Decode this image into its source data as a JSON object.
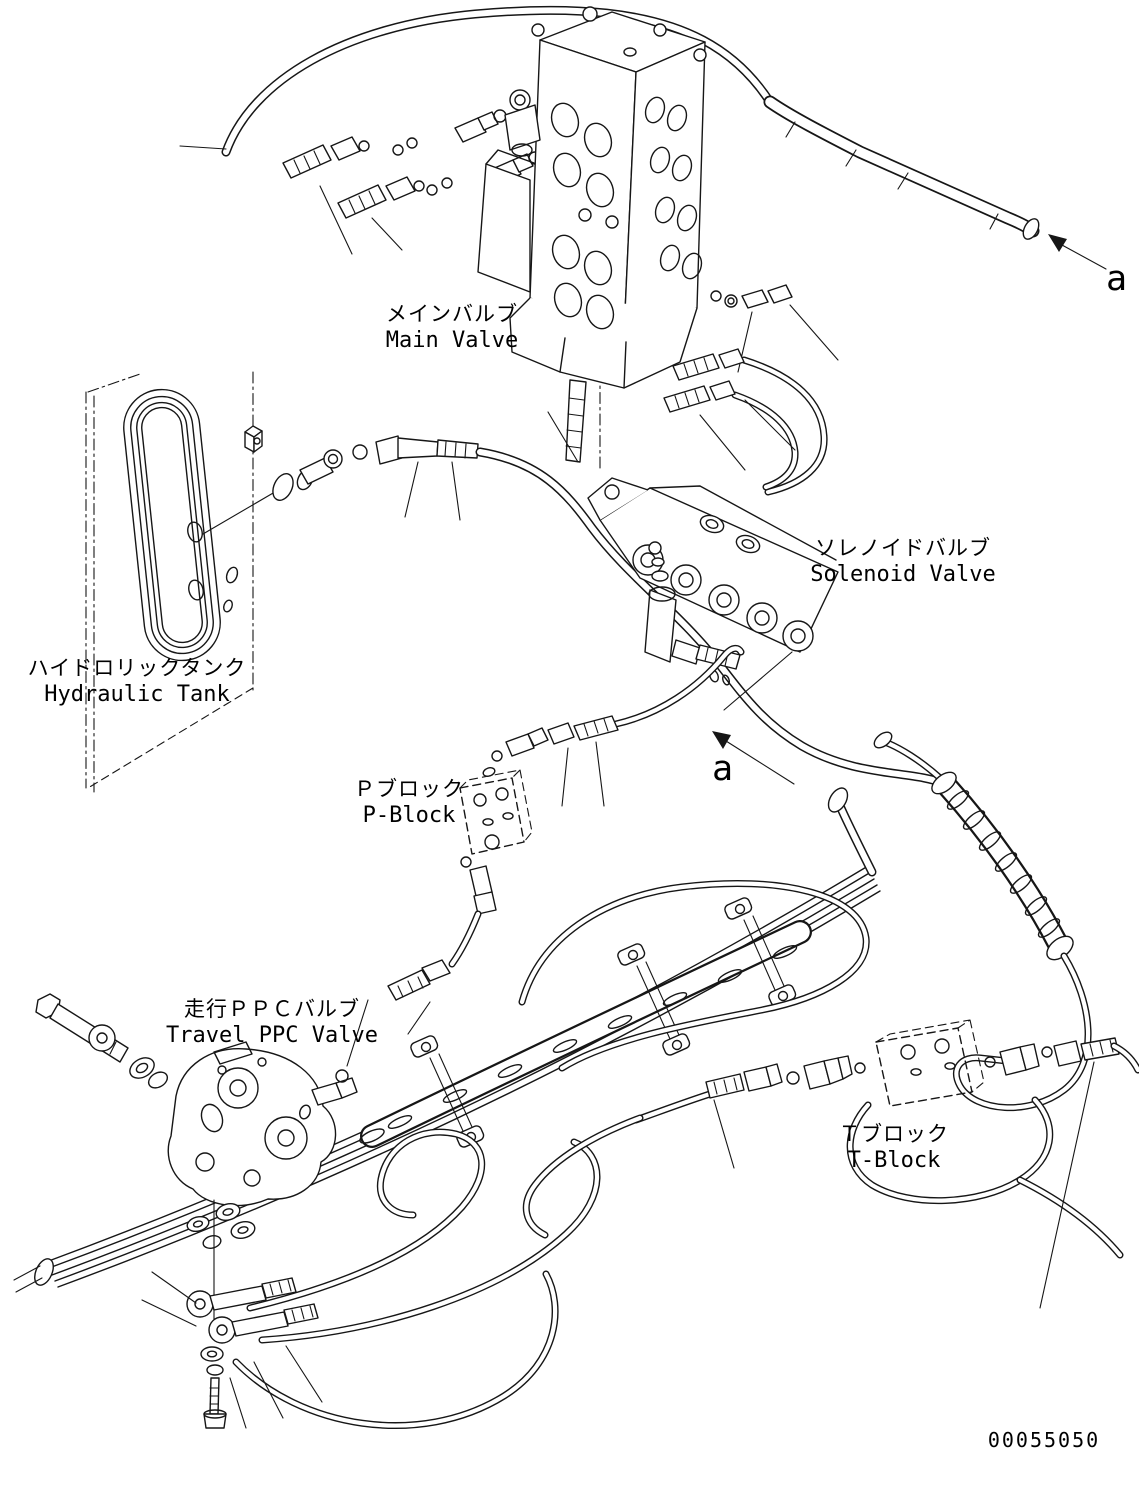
{
  "labels": {
    "main_valve": {
      "jp": "メインバルブ",
      "en": "Main Valve"
    },
    "hydraulic_tank": {
      "jp": "ハイドロリックタンク",
      "en": "Hydraulic Tank"
    },
    "solenoid_valve": {
      "jp": "ソレノイドバルブ",
      "en": "Solenoid Valve"
    },
    "p_block": {
      "jp": "Ｐブロック",
      "en": "P-Block"
    },
    "travel_ppc_valve": {
      "jp": "走行ＰＰＣバルブ",
      "en": "Travel PPC Valve"
    },
    "t_block": {
      "jp": "Ｔブロック",
      "en": "T-Block"
    }
  },
  "view_markers": {
    "top_right": "a",
    "middle": "a"
  },
  "drawing_number": "00055050",
  "colors": {
    "line": "#161616",
    "background": "#ffffff"
  }
}
